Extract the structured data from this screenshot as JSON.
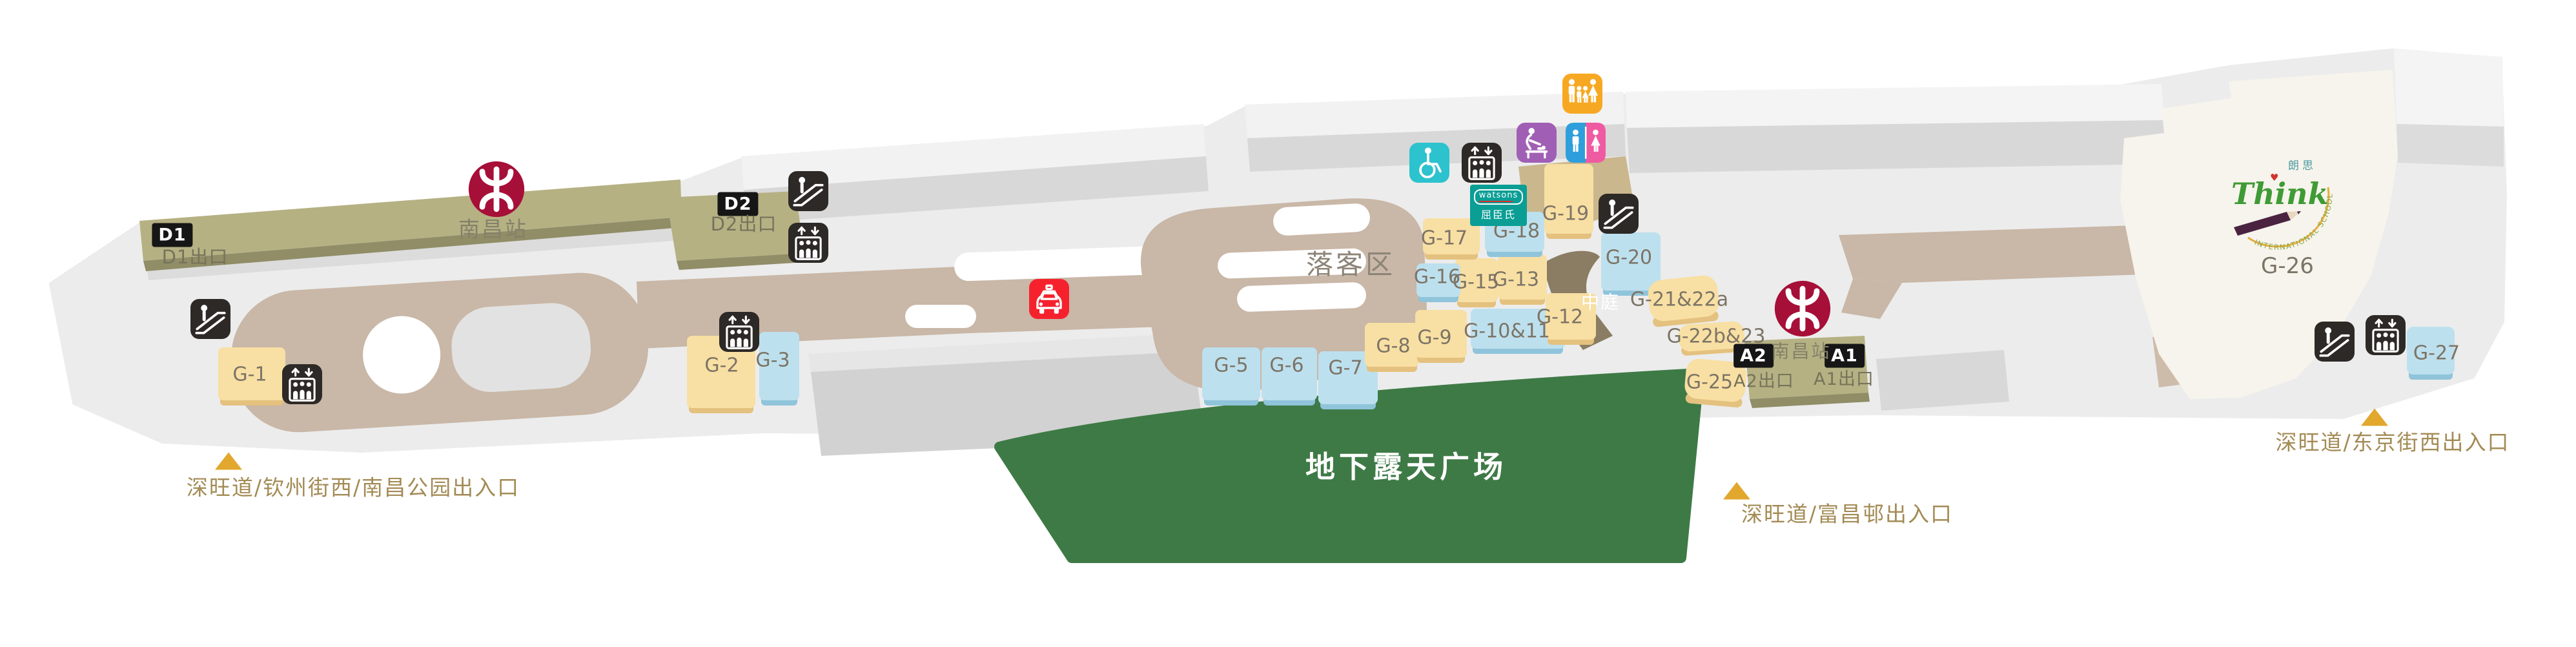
{
  "palette": {
    "mtr_red": "#A60F38",
    "road_tan": "#C9B7A7",
    "platform_olive": "#B6B183",
    "shop_yellow": "#F8DFA3",
    "shop_blue": "#BDE0EE",
    "plaza_green": "#3E7A46",
    "watsons_teal": "#0A9E95",
    "taxi_red": "#F5222E",
    "icon_black": "#2D2926",
    "entrance_gold": "#E2A82E",
    "accessible_teal": "#2CC2CE",
    "babycare_purple": "#A05FB5",
    "family_orange": "#F7A823",
    "male_blue": "#2E9FDB",
    "female_pink": "#EF5BA0"
  },
  "stations": {
    "left": {
      "name": "南昌站",
      "exits": [
        {
          "badge": "D1",
          "label": "D1出口"
        }
      ]
    },
    "d2": {
      "badge": "D2",
      "label": "D2出口"
    },
    "right": {
      "name": "南昌站",
      "exits": [
        {
          "badge": "A2",
          "label": "A2出口"
        },
        {
          "badge": "A1",
          "label": "A1出口"
        }
      ]
    }
  },
  "areas": {
    "dropoff": "落客区",
    "atrium": "中庭",
    "plaza": "地下露天广场"
  },
  "shops": {
    "g1": "G-1",
    "g2": "G-2",
    "g3": "G-3",
    "g5": "G-5",
    "g6": "G-6",
    "g7": "G-7",
    "g8": "G-8",
    "g9": "G-9",
    "g10_11": "G-10&11",
    "g12": "G-12",
    "g13": "G-13",
    "g15": "G-15",
    "g16": "G-16",
    "g17": "G-17",
    "g18": "G-18",
    "g19": "G-19",
    "g20": "G-20",
    "g21_22a": "G-21&22a",
    "g22b_23": "G-22b&23",
    "g25": "G-25",
    "g26": "G-26",
    "g27": "G-27"
  },
  "tenants": {
    "watsons": {
      "latin": "watsons",
      "chinese": "屈臣氏"
    },
    "think": {
      "latin": "Think",
      "chinese": "朗思",
      "arc": "INTERNATIONAL SCHOOL"
    }
  },
  "entrances": {
    "west": "深旺道/钦州街西/南昌公园出入口",
    "south": "深旺道/富昌邨出入口",
    "east": "深旺道/东京街西出入口"
  }
}
